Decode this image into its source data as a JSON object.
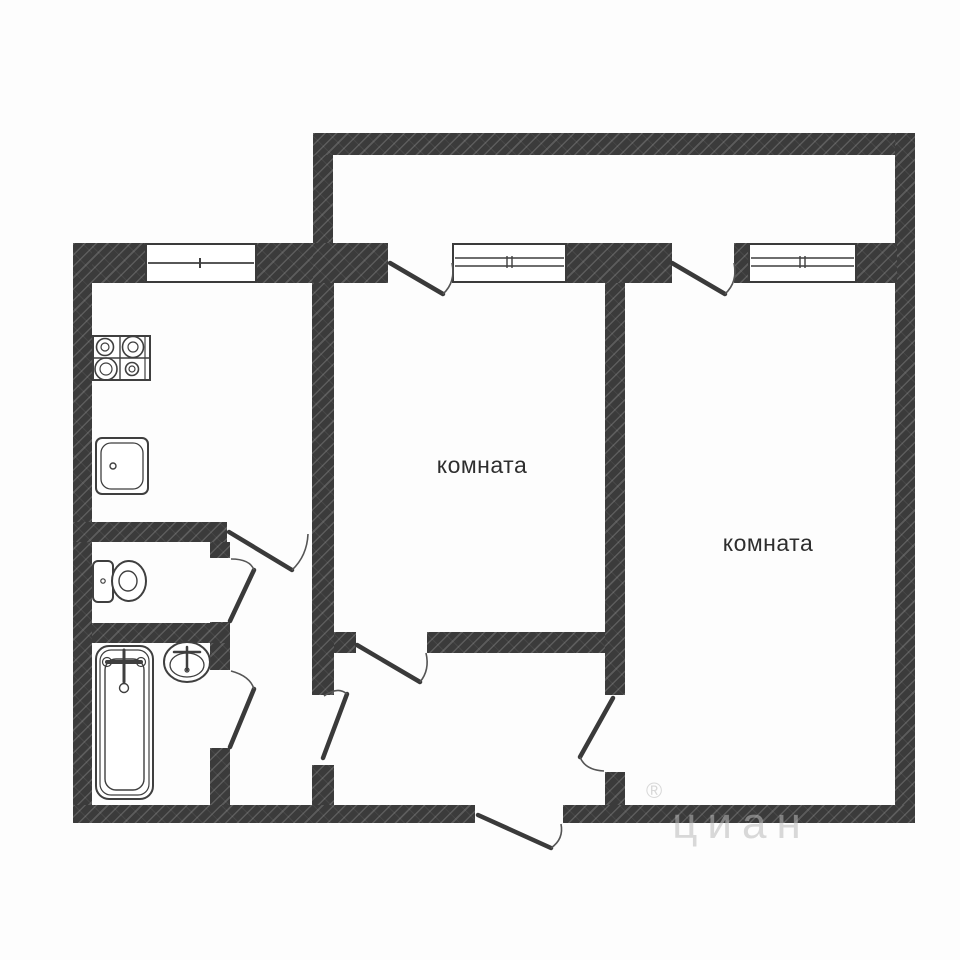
{
  "plan": {
    "type": "floor-plan",
    "rooms": [
      {
        "id": "room-1",
        "label": "комната"
      },
      {
        "id": "room-2",
        "label": "комната"
      }
    ],
    "fixtures": [
      "stove-icon",
      "kitchen-sink-icon",
      "toilet-icon",
      "bathtub-icon",
      "bathroom-sink-icon"
    ],
    "windows_count": 3,
    "door_swings_count": 9,
    "colors": {
      "wall": "#3b3b3b",
      "hatch_line": "rgba(255,255,255,0.17)",
      "fixture_line": "#3f3f3f",
      "background": "#fdfdfd",
      "label_text": "#2e2e2e"
    }
  },
  "watermark": {
    "symbol": "®",
    "text": "циан",
    "color": "#bababa"
  }
}
